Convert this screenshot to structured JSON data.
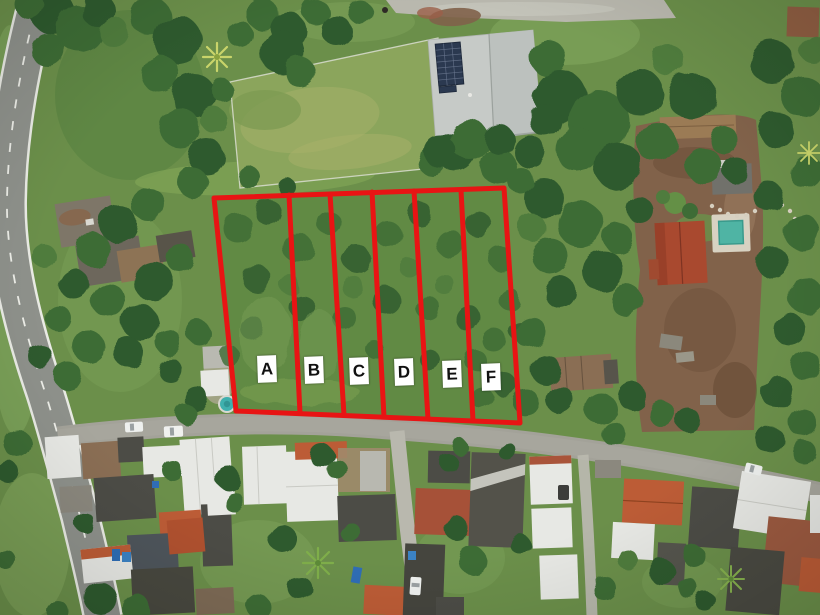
{
  "meta": {
    "description": "Aerial drone photograph of a rural land parcel subdivided into six lots outlined in red and labeled A to F, bordered by a curved asphalt road on the left, a grass sports field and metal-roof building with solar panels at the top, a dirt homestead with a swimming pool on the right, and dense housing along a gravel street at the bottom.",
    "width_px": 820,
    "height_px": 615
  },
  "plots": {
    "outline_color": "#e81414",
    "labels": [
      {
        "letter": "A",
        "cx": 267,
        "cy": 369
      },
      {
        "letter": "B",
        "cx": 314,
        "cy": 370
      },
      {
        "letter": "C",
        "cx": 359,
        "cy": 371
      },
      {
        "letter": "D",
        "cx": 404,
        "cy": 372
      },
      {
        "letter": "E",
        "cx": 452,
        "cy": 374
      },
      {
        "letter": "F",
        "cx": 491,
        "cy": 377
      }
    ]
  },
  "palette": {
    "grass_base": "#6b8f4a",
    "grass_bright": "#7da25a",
    "grass_field": "#8ba55c",
    "grass_field_light": "#9fae66",
    "tree_dark": "#2f5a2e",
    "tree_mid": "#3e6c36",
    "tree_light": "#4f7c3e",
    "tree_highlight": "#649046",
    "road_asphalt": "#8e918b",
    "road_line": "#e9eae4",
    "gravel": "#a3a299",
    "gravel_light": "#b9b8ae",
    "dirt": "#81624a",
    "dirt_dark": "#6b4f39",
    "roof_white": "#e7e8e4",
    "roof_gray": "#c6cac7",
    "roof_dark": "#4c4c46",
    "roof_rust": "#8a6e54",
    "roof_red": "#a9492f",
    "roof_orange": "#bc5c36",
    "solar_panel": "#2b3950",
    "pool_water": "#4fb4a4",
    "pool_round": "#3fb0ae",
    "plot_outline": "#e81414",
    "label_bg": "#ffffff",
    "label_text": "#111111"
  }
}
